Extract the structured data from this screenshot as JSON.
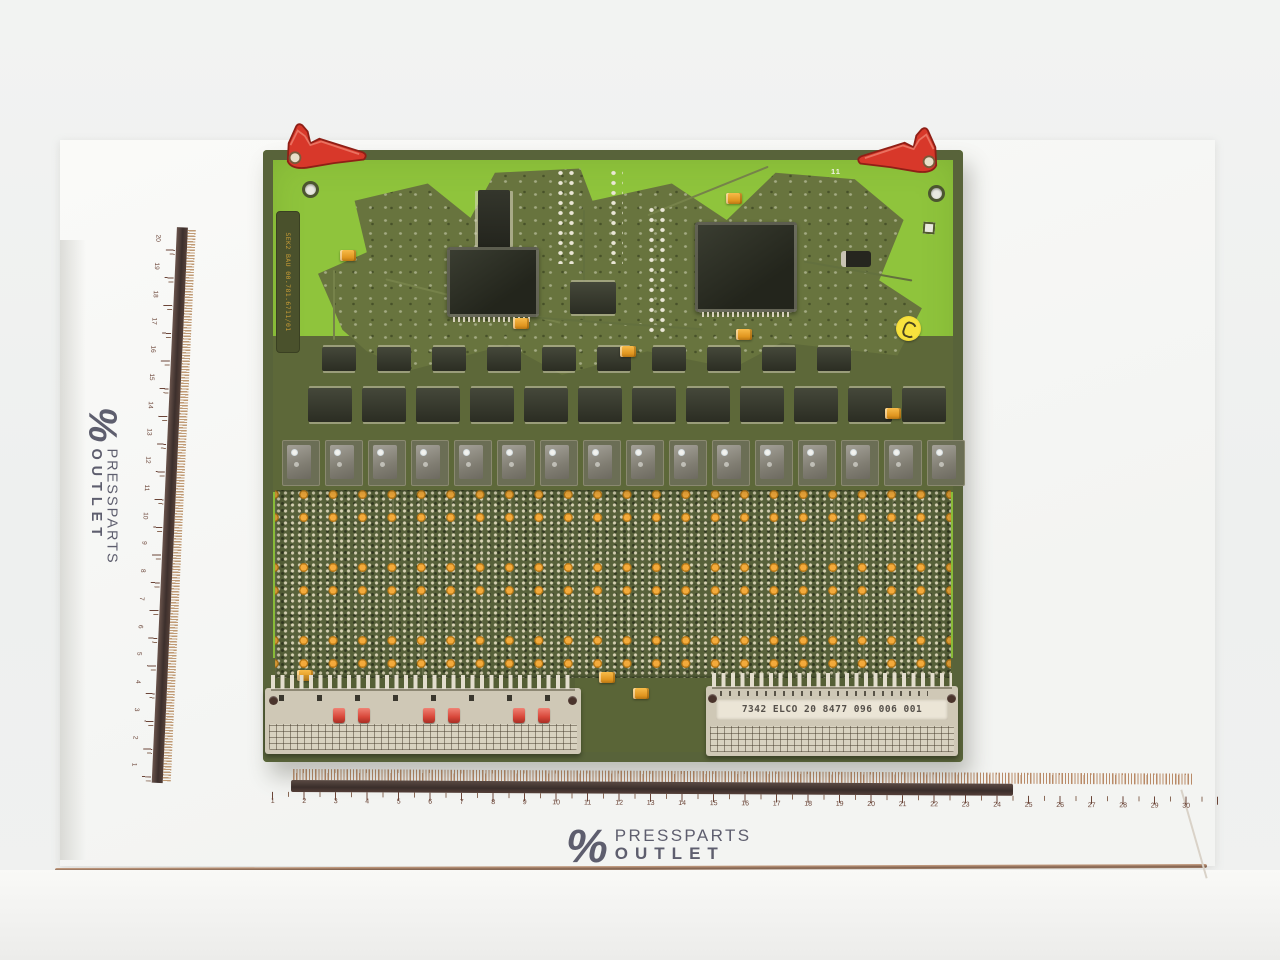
{
  "photo": {
    "subject": "printed circuit board with rulers",
    "colors": {
      "board_green": "#8fc43c",
      "board_olive": "#5d6839",
      "capacitor_yellow": "#f4ab3c",
      "lever_red": "#d8382a",
      "connector_beige": "#cfc8b6",
      "ruler_brown": "#6b4538",
      "logo_navy": "#4a4a5c"
    }
  },
  "watermark": {
    "percent": "%",
    "line1": "PRESSPARTS",
    "line2": "OUTLET"
  },
  "board": {
    "silk_label": "SEK2 BAU 00.781.6711/01",
    "silk_mark": "11",
    "connector_label": "7342 ELCO 20 8477 096 006 001",
    "component_counts": {
      "soic_row_small": 10,
      "soic_row_large": 12,
      "driver_ic_row": 16
    }
  },
  "rulers": {
    "bottom_numbers": [
      "1",
      "2",
      "3",
      "4",
      "5",
      "6",
      "7",
      "8",
      "9",
      "10",
      "11",
      "12",
      "13",
      "14",
      "15",
      "16",
      "17",
      "18",
      "19",
      "20",
      "21",
      "22",
      "23",
      "24",
      "25",
      "26",
      "27",
      "28",
      "29",
      "30"
    ],
    "left_numbers": [
      "20",
      "19",
      "18",
      "17",
      "16",
      "15",
      "14",
      "13",
      "12",
      "11",
      "10",
      "9",
      "8",
      "7",
      "6",
      "5",
      "4",
      "3",
      "2",
      "1"
    ]
  }
}
